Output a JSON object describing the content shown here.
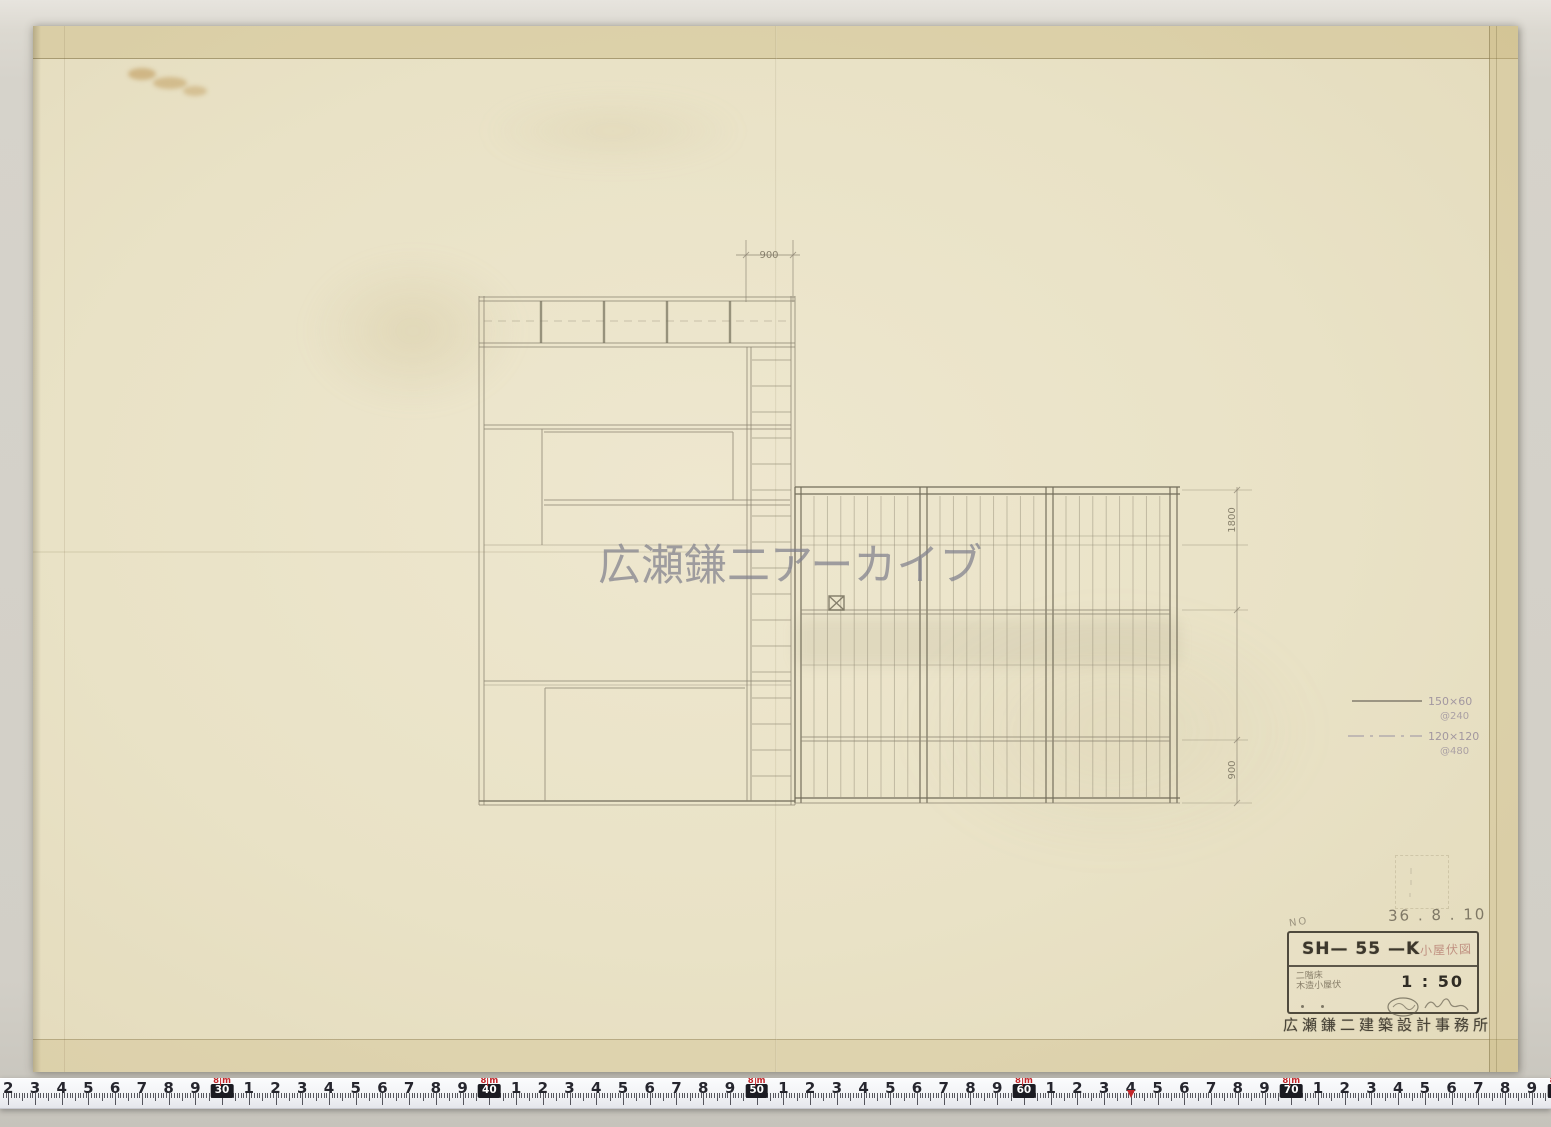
{
  "watermark": {
    "text": "広瀬鎌二アーカイブ"
  },
  "dimensions": {
    "top": "900",
    "right_upper": "1800",
    "right_lower": "900"
  },
  "legend": {
    "items": [
      {
        "style": "solid",
        "label": "150×60",
        "spacing": "@240"
      },
      {
        "style": "dash-dot",
        "label": "120×120",
        "spacing": "@480"
      }
    ]
  },
  "title_block": {
    "no_label": "NO",
    "date": "36 . 8 . 10",
    "code": "SH— 55 —K",
    "stamp": "小屋伏図",
    "note_line1": "二階床",
    "note_line2": "木造小屋伏",
    "scale": "1 : 50",
    "office": "広瀬鎌二建築設計事務所"
  },
  "ruler": {
    "unit": "cm",
    "start_cm": 22,
    "end_cm": 81,
    "px_per_cm": 26.73,
    "origin_x": 8.2,
    "decade_boxes": [
      "30",
      "40",
      "50",
      "60",
      "70",
      "80"
    ],
    "meter_flag": {
      "digit": "8",
      "unit": "m"
    },
    "arrow_cm": 64
  }
}
